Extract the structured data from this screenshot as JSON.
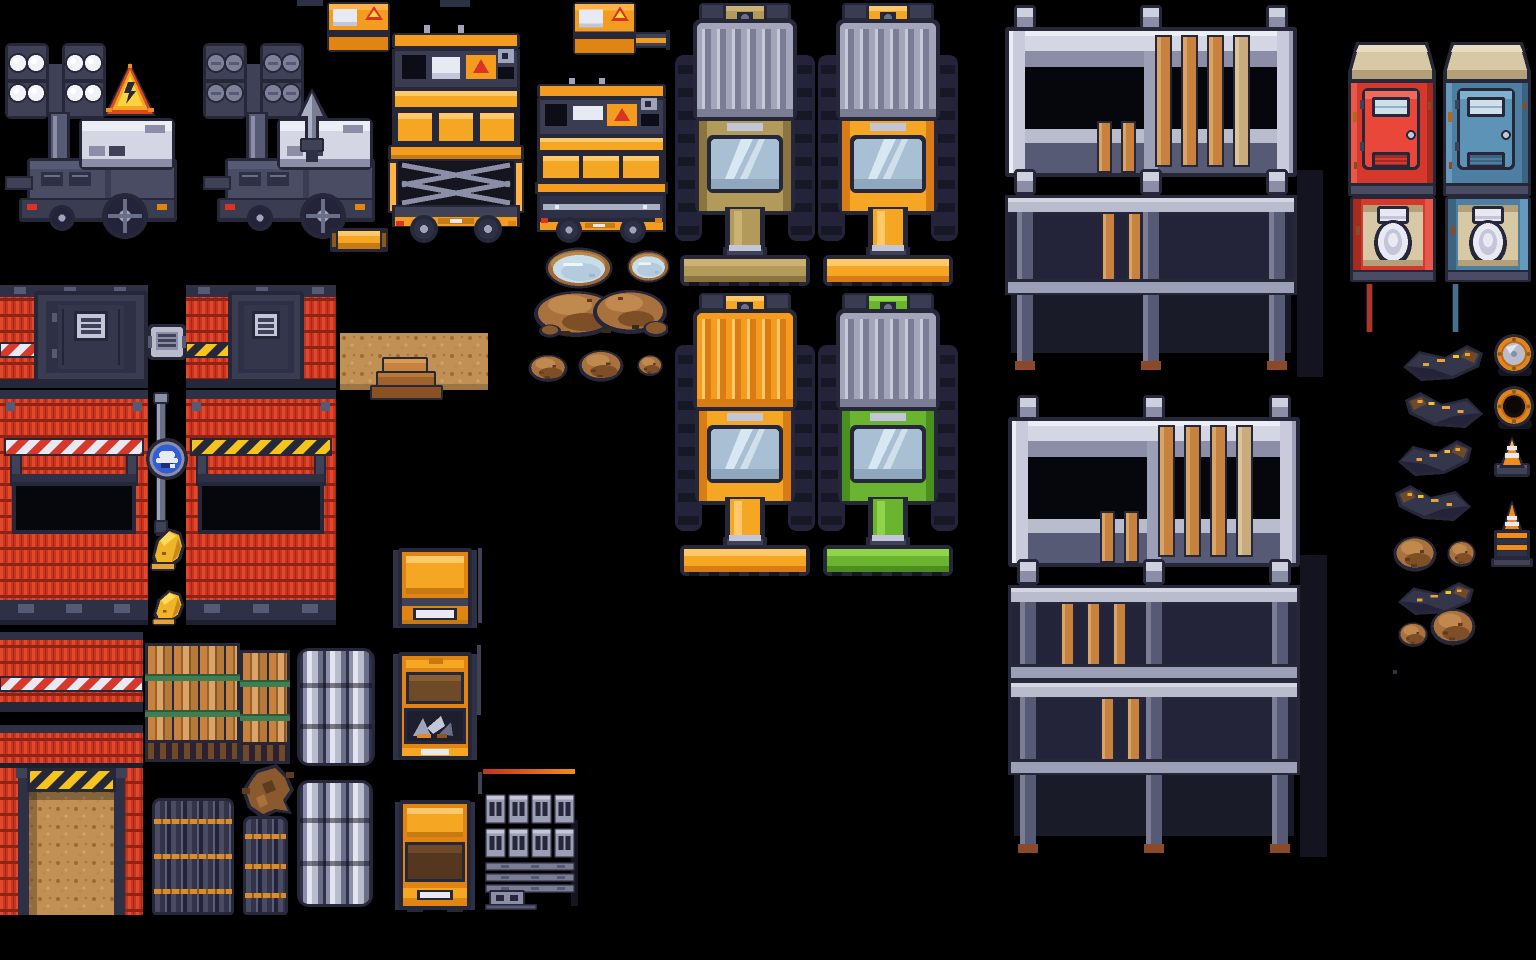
{
  "meta": {
    "app": "pixel-art-construction-tileset-spritesheet",
    "background": "#000000",
    "canvas": {
      "w": 1536,
      "h": 960
    }
  },
  "palette": {
    "outline": "#262738",
    "black": "#06070d",
    "dark": "#2e3046",
    "gray_dark": "#3f4157",
    "gray": "#6b6e87",
    "gray_mid": "#8b8ea6",
    "gray_light": "#b9bccd",
    "gray_lighter": "#c9cbdc",
    "white": "#e8e9f2",
    "orange": "#f39c1f",
    "orange_bright": "#f5a623",
    "orange_light": "#ffc96b",
    "orange_dark": "#d97c16",
    "orange_deep": "#e08414",
    "red": "#d6392b",
    "red_wall": "#c9341f",
    "red_wall_light": "#e0492c",
    "red_wall_seam": "#8e2315",
    "yellow": "#f5c51d",
    "tan": "#b29a5a",
    "green": "#6ab42f",
    "glass": "#a9bfd4",
    "wood": "#c8823f",
    "wood_dark": "#9c5f28",
    "wood_light": "#d9a468",
    "dirt": "#c09055",
    "mound": "#a9713d",
    "water": "#c9dde9",
    "blue_sign": "#2f5ed6",
    "porta_red": "#d6392b",
    "porta_blue": "#4d7fa3",
    "roof_tan": "#d8c9a6",
    "hat_yellow": "#f0b429"
  },
  "sprites": [
    {
      "name": "light-tower-on",
      "type": "lightTower",
      "x": 5,
      "y": 40,
      "w": 176,
      "h": 200,
      "lights": "on"
    },
    {
      "name": "light-tower-off",
      "type": "lightTower",
      "x": 203,
      "y": 40,
      "w": 176,
      "h": 200,
      "lights": "off"
    },
    {
      "name": "lightning-spike",
      "type": "spike",
      "x": 292,
      "y": 88,
      "w": 40,
      "h": 74
    },
    {
      "name": "hazard-triangle-sign",
      "type": "triangleSign",
      "x": 104,
      "y": 62,
      "w": 52,
      "h": 56
    },
    {
      "name": "top-fragment",
      "type": "fragment",
      "x": 297,
      "y": 0,
      "w": 26,
      "h": 6
    },
    {
      "name": "top-fragment",
      "type": "fragment",
      "x": 440,
      "y": 0,
      "w": 30,
      "h": 7
    },
    {
      "name": "generator-box",
      "type": "generator",
      "x": 327,
      "y": 0,
      "w": 63,
      "h": 52
    },
    {
      "name": "generator-box",
      "type": "generator",
      "x": 573,
      "y": 0,
      "w": 63,
      "h": 55
    },
    {
      "name": "boom-arm",
      "type": "boom",
      "x": 634,
      "y": 30,
      "w": 36,
      "h": 20
    },
    {
      "name": "orange-beam",
      "type": "beam",
      "x": 330,
      "y": 228,
      "w": 58,
      "h": 24
    },
    {
      "name": "scissor-lift-extended",
      "type": "liftExt",
      "x": 388,
      "y": 25,
      "w": 136,
      "h": 220
    },
    {
      "name": "scissor-lift-lowered",
      "type": "liftLow",
      "x": 535,
      "y": 78,
      "w": 133,
      "h": 167
    },
    {
      "name": "bulldozer-tan",
      "type": "dozer",
      "x": 675,
      "y": 3,
      "w": 140,
      "h": 283,
      "hood": "gray",
      "cab": "tan"
    },
    {
      "name": "bulldozer-orange-cab",
      "type": "dozer",
      "x": 818,
      "y": 3,
      "w": 140,
      "h": 283,
      "hood": "gray",
      "cab": "orange"
    },
    {
      "name": "bulldozer-orange",
      "type": "dozer",
      "x": 675,
      "y": 293,
      "w": 140,
      "h": 283,
      "hood": "orange",
      "cab": "orange"
    },
    {
      "name": "bulldozer-green",
      "type": "dozer",
      "x": 818,
      "y": 293,
      "w": 140,
      "h": 283,
      "hood": "gray",
      "cab": "green"
    },
    {
      "name": "scaffold-shadow",
      "type": "shadow",
      "x": 1297,
      "y": 170,
      "w": 26,
      "h": 207
    },
    {
      "name": "scaffold-2-level",
      "type": "scaffold",
      "x": 1005,
      "y": 5,
      "w": 292,
      "h": 372,
      "levels": 2
    },
    {
      "name": "scaffold-shadow",
      "type": "shadow",
      "x": 1300,
      "y": 555,
      "w": 27,
      "h": 302
    },
    {
      "name": "scaffold-3-level",
      "type": "scaffold",
      "x": 1008,
      "y": 395,
      "w": 292,
      "h": 465,
      "levels": 3
    },
    {
      "name": "porta-potty-red-front",
      "type": "portaClosed",
      "x": 1348,
      "y": 42,
      "w": 88,
      "h": 160,
      "color": "red"
    },
    {
      "name": "porta-potty-blue-front",
      "type": "portaClosed",
      "x": 1443,
      "y": 42,
      "w": 88,
      "h": 160,
      "color": "blue"
    },
    {
      "name": "porta-potty-red-open",
      "type": "portaOpen",
      "x": 1350,
      "y": 196,
      "w": 86,
      "h": 88,
      "color": "red"
    },
    {
      "name": "porta-potty-blue-open",
      "type": "portaOpen",
      "x": 1445,
      "y": 196,
      "w": 86,
      "h": 88,
      "color": "blue"
    },
    {
      "name": "drain-hose-red",
      "type": "hose",
      "x": 1366,
      "y": 284,
      "w": 7,
      "h": 48,
      "color": "#b03325"
    },
    {
      "name": "drain-hose-blue",
      "type": "hose",
      "x": 1452,
      "y": 284,
      "w": 7,
      "h": 48,
      "color": "#44718f"
    },
    {
      "name": "debris-streak",
      "type": "debris",
      "x": 1403,
      "y": 345,
      "w": 80,
      "h": 36,
      "flip": false
    },
    {
      "name": "barrel-closed",
      "type": "barrel",
      "x": 1493,
      "y": 333,
      "w": 43,
      "h": 45,
      "open": false
    },
    {
      "name": "debris-streak",
      "type": "debris",
      "x": 1405,
      "y": 392,
      "w": 78,
      "h": 36,
      "flip": true
    },
    {
      "name": "barrel-open",
      "type": "barrel",
      "x": 1493,
      "y": 385,
      "w": 43,
      "h": 46,
      "open": true
    },
    {
      "name": "debris-streak",
      "type": "debris",
      "x": 1398,
      "y": 440,
      "w": 74,
      "h": 36,
      "flip": false
    },
    {
      "name": "traffic-cone",
      "type": "cone",
      "x": 1492,
      "y": 434,
      "w": 40,
      "h": 45
    },
    {
      "name": "debris-streak",
      "type": "debris",
      "x": 1395,
      "y": 485,
      "w": 76,
      "h": 36,
      "flip": true
    },
    {
      "name": "cone-pedestal",
      "type": "conePed",
      "x": 1490,
      "y": 500,
      "w": 44,
      "h": 67
    },
    {
      "name": "dirt-mound",
      "type": "mound",
      "x": 1393,
      "y": 533,
      "w": 44,
      "h": 40
    },
    {
      "name": "dirt-mound",
      "type": "mound",
      "x": 1447,
      "y": 538,
      "w": 29,
      "h": 30
    },
    {
      "name": "debris-streak",
      "type": "debris",
      "x": 1398,
      "y": 582,
      "w": 76,
      "h": 33,
      "flip": false
    },
    {
      "name": "dirt-mound",
      "type": "mound",
      "x": 1430,
      "y": 605,
      "w": 46,
      "h": 42
    },
    {
      "name": "dirt-mound",
      "type": "mound",
      "x": 1398,
      "y": 620,
      "w": 30,
      "h": 28
    },
    {
      "name": "paint-fleck",
      "type": "fragment",
      "x": 1393,
      "y": 670,
      "w": 4,
      "h": 4
    },
    {
      "name": "puddle",
      "type": "puddle",
      "x": 545,
      "y": 247,
      "w": 68,
      "h": 42
    },
    {
      "name": "puddle",
      "type": "puddle",
      "x": 627,
      "y": 250,
      "w": 43,
      "h": 33
    },
    {
      "name": "dirt-mound-double",
      "type": "moundDouble",
      "x": 532,
      "y": 285,
      "w": 136,
      "h": 53
    },
    {
      "name": "dirt-mound",
      "type": "mound",
      "x": 528,
      "y": 352,
      "w": 40,
      "h": 31
    },
    {
      "name": "dirt-mound",
      "type": "mound",
      "x": 578,
      "y": 347,
      "w": 46,
      "h": 36
    },
    {
      "name": "dirt-mound",
      "type": "mound",
      "x": 637,
      "y": 353,
      "w": 26,
      "h": 24
    },
    {
      "name": "container-wall-door-left",
      "type": "wallDoorA",
      "x": 0,
      "y": 285,
      "w": 148,
      "h": 103
    },
    {
      "name": "keypad-tile",
      "type": "keypad",
      "x": 148,
      "y": 322,
      "w": 38,
      "h": 40
    },
    {
      "name": "container-wall-door-right",
      "type": "wallDoorB",
      "x": 186,
      "y": 285,
      "w": 150,
      "h": 103
    },
    {
      "name": "dirt-patch",
      "type": "dirtPatch",
      "x": 340,
      "y": 333,
      "w": 148,
      "h": 57
    },
    {
      "name": "wood-steps",
      "type": "steps",
      "x": 370,
      "y": 355,
      "w": 73,
      "h": 45
    },
    {
      "name": "container-wall-window-left",
      "type": "wallWin",
      "x": 0,
      "y": 390,
      "w": 148,
      "h": 235,
      "rail": "wr"
    },
    {
      "name": "container-wall-window-right",
      "type": "wallWin",
      "x": 186,
      "y": 390,
      "w": 150,
      "h": 235,
      "rail": "yb"
    },
    {
      "name": "sign-pole",
      "type": "pole",
      "x": 153,
      "y": 392,
      "w": 16,
      "h": 152
    },
    {
      "name": "hard-hat-sign",
      "type": "signHat",
      "x": 146,
      "y": 436,
      "w": 42,
      "h": 46
    },
    {
      "name": "hard-hat",
      "type": "hardHat",
      "x": 148,
      "y": 522,
      "w": 40,
      "h": 52
    },
    {
      "name": "hard-hat",
      "type": "hardHat",
      "x": 150,
      "y": 585,
      "w": 37,
      "h": 43
    },
    {
      "name": "container-wall-strip",
      "type": "wallStrip",
      "x": 0,
      "y": 632,
      "w": 143,
      "h": 80,
      "stripe": true
    },
    {
      "name": "container-wall-strip",
      "type": "wallStrip",
      "x": 0,
      "y": 725,
      "w": 143,
      "h": 43,
      "stripe": false
    },
    {
      "name": "garage-entrance",
      "type": "garage",
      "x": 0,
      "y": 768,
      "w": 143,
      "h": 147
    },
    {
      "name": "timber-bundle",
      "type": "timber",
      "x": 145,
      "y": 643,
      "w": 95,
      "h": 119
    },
    {
      "name": "timber-bundle",
      "type": "timber",
      "x": 240,
      "y": 650,
      "w": 50,
      "h": 114
    },
    {
      "name": "tree-stump-roots",
      "type": "stump",
      "x": 242,
      "y": 764,
      "w": 52,
      "h": 55
    },
    {
      "name": "rebar-bundle",
      "type": "rebar",
      "x": 152,
      "y": 798,
      "w": 82,
      "h": 117
    },
    {
      "name": "rebar-bundle",
      "type": "rebar",
      "x": 243,
      "y": 816,
      "w": 45,
      "h": 99
    },
    {
      "name": "pipe-stack",
      "type": "pipes",
      "x": 297,
      "y": 648,
      "w": 78,
      "h": 118
    },
    {
      "name": "pipe-stack",
      "type": "pipes",
      "x": 297,
      "y": 780,
      "w": 76,
      "h": 127
    },
    {
      "name": "orange-crate-closed",
      "type": "crateClosed",
      "x": 393,
      "y": 548,
      "w": 84,
      "h": 82
    },
    {
      "name": "orange-crate-tools",
      "type": "crateTools",
      "x": 393,
      "y": 652,
      "w": 84,
      "h": 110
    },
    {
      "name": "orange-crate-drawer",
      "type": "crateDrawer",
      "x": 395,
      "y": 800,
      "w": 80,
      "h": 112
    },
    {
      "name": "rebar-rod",
      "type": "rodV",
      "x": 478,
      "y": 548,
      "w": 4,
      "h": 75
    },
    {
      "name": "rebar-rod",
      "type": "rodV",
      "x": 477,
      "y": 645,
      "w": 4,
      "h": 70
    },
    {
      "name": "rebar-rod",
      "type": "rodV",
      "x": 478,
      "y": 772,
      "w": 4,
      "h": 22
    },
    {
      "name": "marking-rod",
      "type": "rodH",
      "x": 483,
      "y": 769,
      "w": 92,
      "h": 5
    },
    {
      "name": "cinder-block-stack",
      "type": "cinder",
      "x": 481,
      "y": 790,
      "w": 97,
      "h": 120
    }
  ]
}
